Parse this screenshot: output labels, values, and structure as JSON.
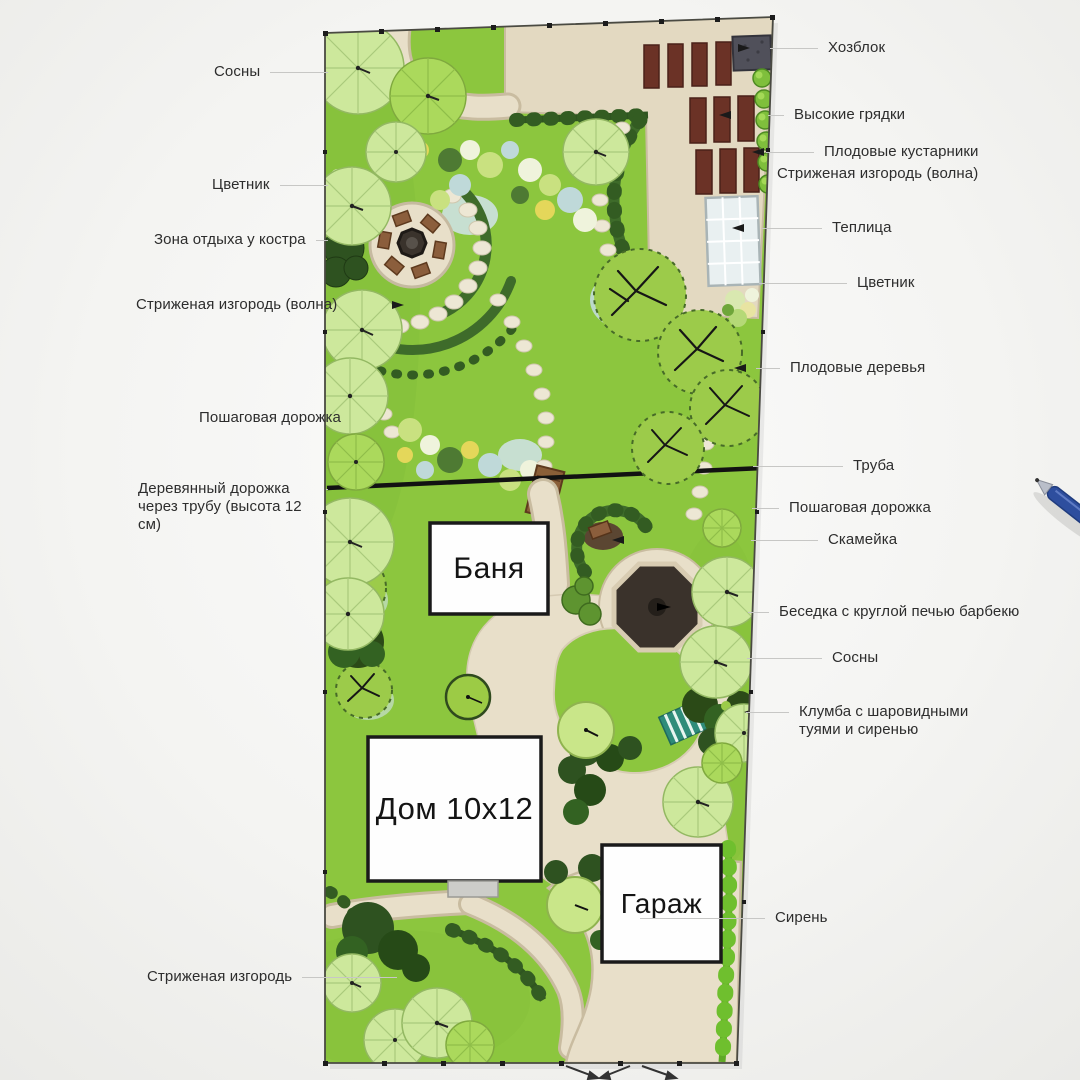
{
  "plan_title": "Garden landscape plan",
  "buildings": {
    "bathhouse": "Баня",
    "house": "Дом 10х12",
    "garage": "Гараж"
  },
  "labels": {
    "left": [
      {
        "text": "Сосны"
      },
      {
        "text": "Цветник"
      },
      {
        "text": "Зона отдыха у костра"
      },
      {
        "text": "Стриженая изгородь (волна)"
      },
      {
        "text": "Пошаговая дорожка"
      },
      {
        "text": "Деревянный дорожка через трубу (высота 12 см)"
      },
      {
        "text": "Стриженая изгородь"
      }
    ],
    "right": [
      {
        "text": "Хозблок"
      },
      {
        "text": "Высокие грядки"
      },
      {
        "text": "Плодовые кустарники"
      },
      {
        "text": "Стриженая изгородь (волна)"
      },
      {
        "text": "Теплица"
      },
      {
        "text": "Цветник"
      },
      {
        "text": "Плодовые деревья"
      },
      {
        "text": "Труба"
      },
      {
        "text": "Пошаговая дорожка"
      },
      {
        "text": "Скамейка"
      },
      {
        "text": "Беседка с круглой печью барбекю"
      },
      {
        "text": "Сосны"
      },
      {
        "text": "Клумба с шаровидными туями и сиренью"
      },
      {
        "text": "Сирень"
      }
    ]
  },
  "icons": {
    "pen": "pen-photo",
    "gate": "gate-symbol"
  },
  "colors": {
    "lawn": "#8CC63E",
    "paving": "#E8DFC9",
    "paving_edge": "#C9BCA0",
    "hedge": "#3E6B2A",
    "hedge_dark": "#2F5520",
    "raised_bed": "#6B3226",
    "shed": "#50505A",
    "gazebo": "#3A322B",
    "greenhouse": "#E9F0F1",
    "water": "#C2DCDC",
    "pine_pale": "#CDE89C",
    "pine_lime": "#ABD95C",
    "bench_wood": "#8B5E3C",
    "lilac_hedge": "#6FBF2E",
    "pen_blue": "#2E4E9E",
    "label_text": "#2D2D2D",
    "leader_line": "#C7C7C5",
    "background": "#F4F4F2"
  }
}
